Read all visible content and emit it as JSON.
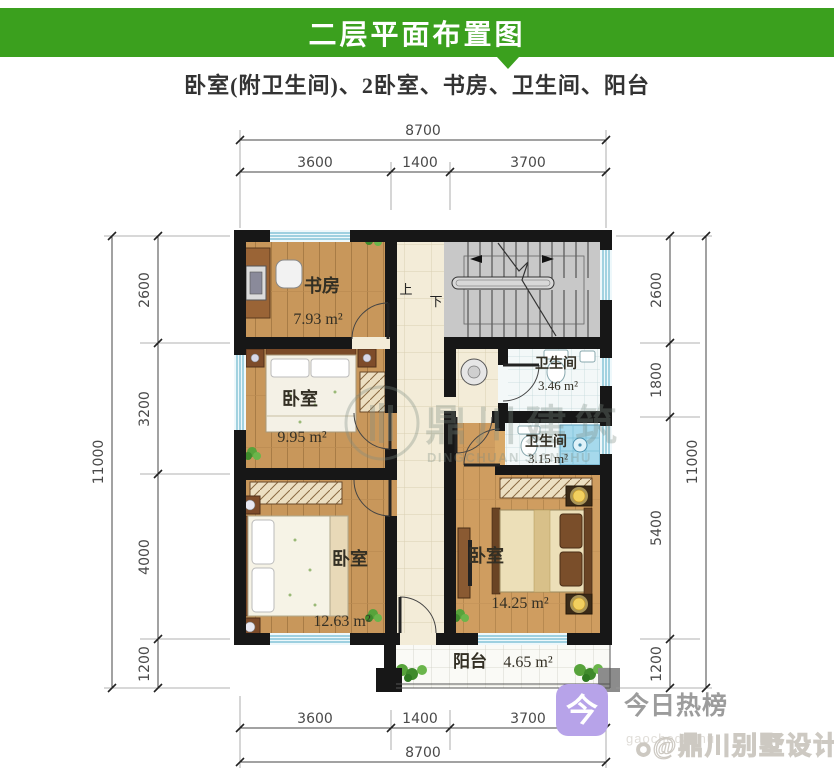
{
  "header": {
    "title": "二层平面布置图",
    "bg_color": "#3ba01e"
  },
  "subtitle": "卧室(附卫生间)、2卧室、书房、卫生间、阳台",
  "dims": {
    "top": {
      "overall": "8700",
      "segments": [
        "3600",
        "1400",
        "3700"
      ]
    },
    "bottom": {
      "overall": "8700",
      "segments": [
        "3600",
        "1400",
        "3700"
      ]
    },
    "left": {
      "overall": "11000",
      "segments": [
        "2600",
        "3200",
        "4000",
        "1200"
      ]
    },
    "right": {
      "overall": "11000",
      "segments": [
        "2600",
        "1800",
        "5400",
        "1200"
      ]
    }
  },
  "rooms": {
    "study": {
      "label": "书房",
      "area": "7.93 m²"
    },
    "bedroom_mid": {
      "label": "卧室",
      "area": "9.95 m²"
    },
    "bedroom_left": {
      "label": "卧室",
      "area": "12.63 m²"
    },
    "bedroom_right": {
      "label": "卧室",
      "area": "14.25 m²"
    },
    "bath_top": {
      "label": "卫生间",
      "area": "3.46 m²"
    },
    "bath_bottom": {
      "label": "卫生间",
      "area": "3.15 m²"
    },
    "balcony": {
      "label": "阳台",
      "area": "4.65 m²"
    }
  },
  "stairs": {
    "up_label": "上",
    "down_label": "下"
  },
  "watermark_center": {
    "cn": "鼎川建筑",
    "en": "DINGCHUAN JIANZHU"
  },
  "footer": {
    "logo_char": "今",
    "brand": "今日热榜",
    "handle": "gaochedazhu",
    "paw": "◉",
    "stamp": "@鼎川别墅设计"
  }
}
